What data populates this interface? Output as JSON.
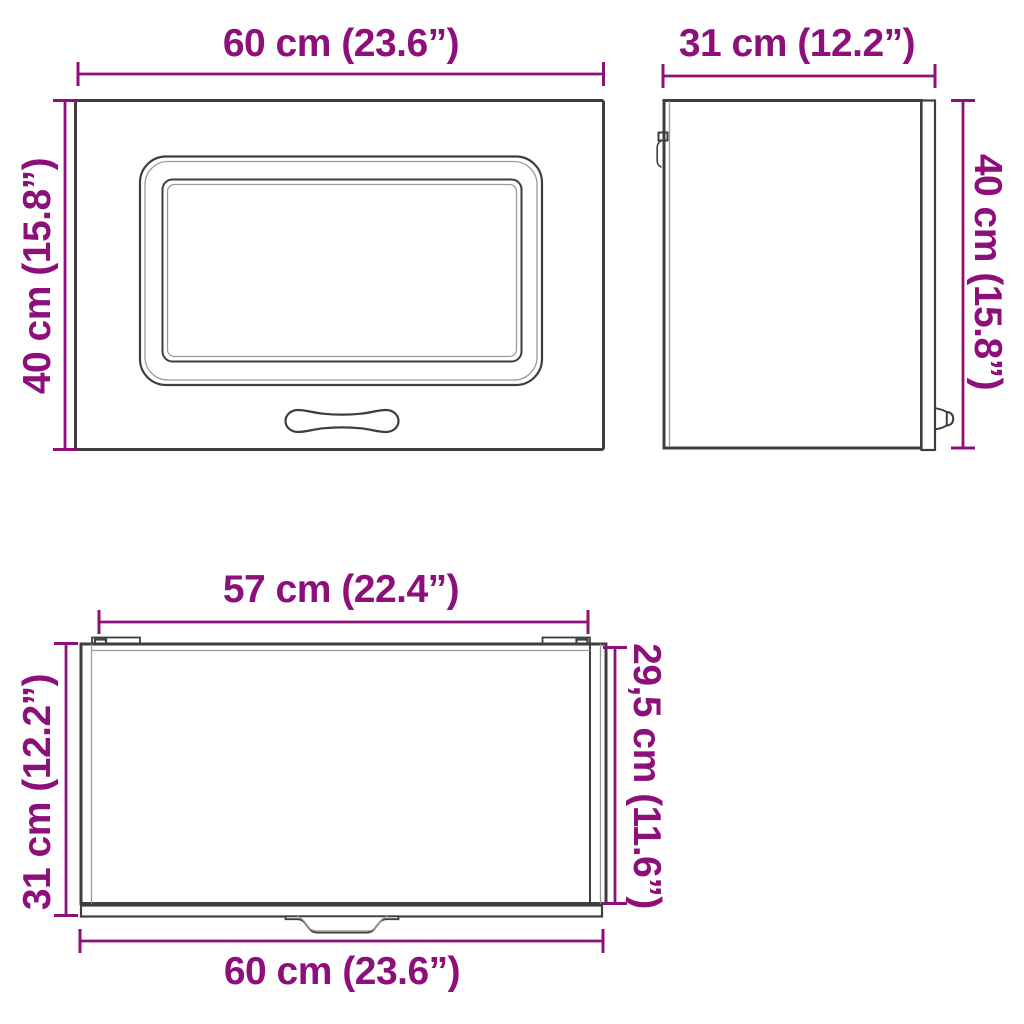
{
  "colors": {
    "accent_dimension": "#8D0F7A",
    "outline": "#3E3E3D",
    "outline_light": "#9B9B99",
    "background": "#FFFFFF"
  },
  "diagram": {
    "views": {
      "front": {
        "width": "60 cm (23.6”)",
        "height": "40 cm (15.8”)"
      },
      "side": {
        "depth": "31 cm (12.2”)",
        "height": "40 cm (15.8”)"
      },
      "top": {
        "inner_width": "57 cm (22.4”)",
        "depth": "31 cm (12.2”)",
        "inner_depth": "29,5 cm (11.6”)",
        "width": "60 cm (23.6”)"
      }
    }
  }
}
